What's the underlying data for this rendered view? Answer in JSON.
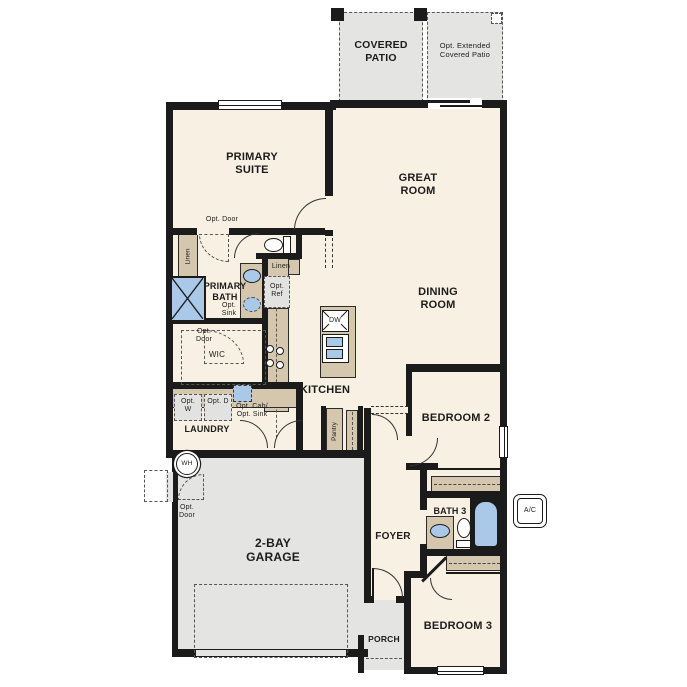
{
  "plan_title": "Single-story floor plan",
  "colors": {
    "wall": "#1b1b1b",
    "floor": "#f8f0e2",
    "hardscape": "#e4e4e2",
    "cabinet_tan": "#d4c7ae",
    "fixture_blue": "#aac9e9"
  },
  "rooms": {
    "covered_patio": "COVERED PATIO",
    "opt_extended_patio": "Opt. Extended Covered Patio",
    "primary_suite": "PRIMARY SUITE",
    "great_room": "GREAT ROOM",
    "dining_room": "DINING ROOM",
    "primary_bath": "PRIMARY BATH",
    "wic": "WIC",
    "kitchen": "KITCHEN",
    "laundry": "LAUNDRY",
    "bedroom2": "BEDROOM 2",
    "bath3": "BATH 3",
    "foyer": "FOYER",
    "garage": "2-BAY GARAGE",
    "porch": "PORCH",
    "bedroom3": "BEDROOM 3"
  },
  "annotations": {
    "opt_door": "Opt. Door",
    "linen": "Linen",
    "opt_sink": "Opt. Sink",
    "opt_ref": "Opt. Ref",
    "opt_w": "Opt. W",
    "opt_d": "Opt. D",
    "opt_cab_sink": "Opt. Cab/ Opt. Sink",
    "pantry": "Pantry",
    "dw": "DW",
    "wh": "WH",
    "ac": "A/C"
  }
}
